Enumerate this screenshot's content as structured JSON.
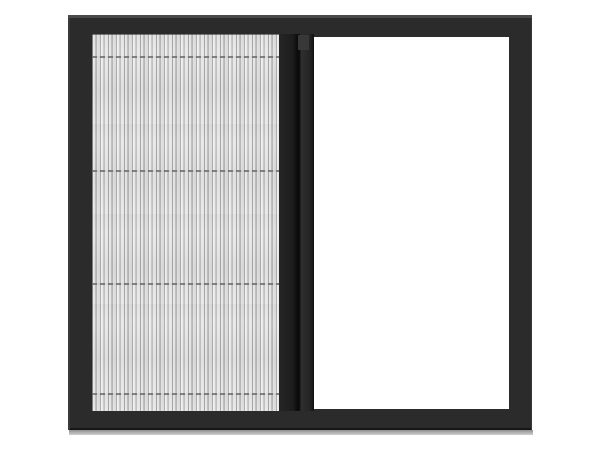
{
  "scene": {
    "subject": "Product photo of a sliding pleated (plisse) insect screen window",
    "state": "Screen half extended: pleated mesh covers the left half, right half open",
    "parts": [
      {
        "name": "window-frame",
        "description": "Dark charcoal rectangular outer frame"
      },
      {
        "name": "pleated-mesh",
        "description": "Accordion-pleated grey mesh panel with vertical pleats and four dashed horizontal fold seams"
      },
      {
        "name": "slider-bar",
        "description": "Dark vertical handle bar at the leading edge of the pleated screen"
      },
      {
        "name": "open-pane",
        "description": "Open white area of the window with no mesh"
      },
      {
        "name": "drop-shadow",
        "description": "Soft grey shadow strip under the bottom rail"
      }
    ]
  },
  "colors": {
    "background": "#ffffff",
    "frame": "#2b2b2b",
    "frame-highlight": "#4a4a4a",
    "frame-edge": "#161616",
    "mesh-base": "#e3e3e3",
    "seam": "#6e6e6e",
    "bar-dark": "#1c1c1c",
    "opening": "#ffffff",
    "shadow-dark": "#8f8f8f",
    "shadow-light": "#cfcfcf"
  }
}
